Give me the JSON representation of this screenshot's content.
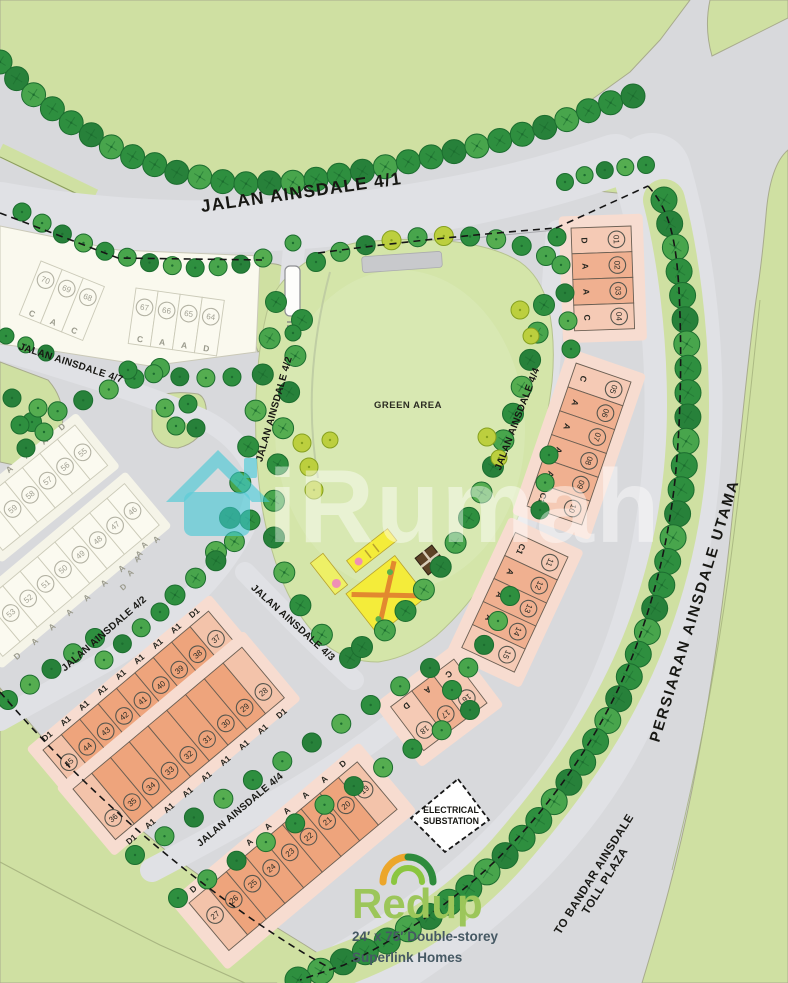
{
  "map": {
    "watermark": {
      "brand": "iRumah"
    },
    "green_area_label": "GREEN AREA",
    "road_labels": [
      {
        "id": "jalan-ainsdale-4-1",
        "text": "JALAN AINSDALE 4/1",
        "x": 302,
        "y": 198,
        "rot": -8,
        "size": 17.5,
        "ls": 1.2
      },
      {
        "id": "jalan-ainsdale-4-7",
        "text": "JALAN AINSDALE 4/7",
        "x": 70,
        "y": 366,
        "rot": 18,
        "size": 10,
        "ls": 0.3
      },
      {
        "id": "jalan-ainsdale-4-2-upper",
        "text": "JALAN AINSDALE 4/2",
        "x": 277,
        "y": 410,
        "rot": -74,
        "size": 10,
        "ls": 0.3
      },
      {
        "id": "jalan-ainsdale-4-2-lower",
        "text": "JALAN AINSDALE 4/2",
        "x": 106,
        "y": 636,
        "rot": -41,
        "size": 10,
        "ls": 0.3
      },
      {
        "id": "jalan-ainsdale-4-3",
        "text": "JALAN AINSDALE 4/3",
        "x": 291,
        "y": 625,
        "rot": 42,
        "size": 10,
        "ls": 0.3
      },
      {
        "id": "jalan-ainsdale-4-4-lower",
        "text": "JALAN AINSDALE 4/4",
        "x": 242,
        "y": 812,
        "rot": -40,
        "size": 10,
        "ls": 0.3
      },
      {
        "id": "jalan-ainsdale-4-4-upper",
        "text": "JALAN AINSDALE 4/4",
        "x": 520,
        "y": 420,
        "rot": -69,
        "size": 10,
        "ls": 0.3
      },
      {
        "id": "persiaran-ainsdale-utama",
        "text": "PERSIARAN AINSDALE UTAMA",
        "x": 699,
        "y": 612,
        "rot": -73,
        "size": 15,
        "ls": 2
      }
    ],
    "toll_label": {
      "lines": [
        "TO BANDAR AINSDALE",
        "TOLL PLAZA"
      ],
      "x": 597,
      "y": 876,
      "rot": -58,
      "size": 11.5
    },
    "substation": {
      "lines": [
        "ELECTRICAL",
        "SUBSTATION"
      ],
      "x": 451,
      "y": 813
    },
    "logo": {
      "name": "Redup",
      "tagline": [
        "24′ x 75′ Double-storey",
        "Superlink Homes"
      ]
    },
    "extra_letters": [
      {
        "t": "A",
        "x": 146,
        "y": 547
      },
      {
        "t": "A",
        "x": 139,
        "y": 561
      },
      {
        "t": "A",
        "x": 132,
        "y": 575
      },
      {
        "t": "D",
        "x": 125,
        "y": 589
      }
    ],
    "lot_rows": [
      {
        "id": "row-37-45",
        "origin": [
          43,
          750
        ],
        "rot": -40,
        "cw": 24,
        "n": 9,
        "depth": 66,
        "pad": 12,
        "numY": 26,
        "letterY": -8,
        "numbers": [
          "45",
          "44",
          "43",
          "42",
          "41",
          "40",
          "39",
          "38",
          "37"
        ],
        "letters": [
          "D1",
          "A1",
          "A1",
          "A1",
          "A1",
          "A1",
          "A1",
          "A1",
          "D1"
        ],
        "style": "pink"
      },
      {
        "id": "row-28-36",
        "origin": [
          73,
          789
        ],
        "rot": -40,
        "cw": 24.5,
        "n": 9,
        "depth": 66,
        "pad": 12,
        "numY": 48,
        "letterY": 76,
        "numbers": [
          "36",
          "35",
          "34",
          "33",
          "32",
          "31",
          "30",
          "29",
          "28"
        ],
        "letters": [
          "D1",
          "A1",
          "A1",
          "A1",
          "A1",
          "A1",
          "A1",
          "A1",
          "D1"
        ],
        "style": "pink"
      },
      {
        "id": "row-19-27",
        "origin": [
          189,
          903
        ],
        "rot": -40,
        "cw": 24.4,
        "n": 9,
        "depth": 62,
        "pad": 14,
        "numY": 26,
        "letterY": -8,
        "numbers": [
          "27",
          "26",
          "25",
          "24",
          "23",
          "22",
          "21",
          "20",
          "19"
        ],
        "letters": [
          "D",
          "A",
          "A",
          "A",
          "A",
          "A",
          "A",
          "A",
          "D"
        ],
        "style": "pink"
      },
      {
        "id": "block-01-04",
        "origin": [
          631,
          226
        ],
        "rot": 88,
        "cw": 25.7,
        "n": 4,
        "depth": 60,
        "pad": 12,
        "numY": 15,
        "letterY": 47,
        "numbers": [
          "01",
          "02",
          "03",
          "04"
        ],
        "letters": [
          "D",
          "A",
          "A",
          "C"
        ],
        "style": "pink2"
      },
      {
        "id": "block-05-10",
        "origin": [
          631,
          382
        ],
        "rot": 109,
        "cw": 25.2,
        "n": 6,
        "depth": 58,
        "pad": 12,
        "numY": 14,
        "letterY": 46,
        "numbers": [
          "05",
          "06",
          "07",
          "08",
          "09",
          "10"
        ],
        "letters": [
          "C",
          "A",
          "A",
          "A",
          "A",
          "C1"
        ],
        "style": "pink2"
      },
      {
        "id": "block-11-15",
        "origin": [
          568,
          557
        ],
        "rot": 115,
        "cw": 25.4,
        "n": 5,
        "depth": 58,
        "pad": 12,
        "numY": 14,
        "letterY": 46,
        "numbers": [
          "11",
          "12",
          "13",
          "14",
          "15"
        ],
        "letters": [
          "C1",
          "A",
          "A",
          "A",
          "C"
        ],
        "style": "pink2"
      },
      {
        "id": "block-16-18",
        "origin": [
          487,
          703
        ],
        "rot": 143,
        "cw": 26.4,
        "n": 3,
        "depth": 55,
        "pad": 12,
        "numY": 16,
        "letterY": 46,
        "numbers": [
          "16",
          "17",
          "18"
        ],
        "letters": [
          "C",
          "A",
          "D"
        ],
        "style": "pink2"
      },
      {
        "id": "row-55-59",
        "origin": [
          -30,
          510
        ],
        "rot": -39,
        "cw": 22.5,
        "n": 6,
        "depth": 52,
        "pad": 9,
        "numY": 26,
        "letterY": -7,
        "numbers": [
          "",
          "59",
          "58",
          "57",
          "56",
          "55"
        ],
        "letters": [
          "",
          "A",
          "A",
          "A",
          "A",
          "D"
        ],
        "style": "white"
      },
      {
        "id": "row-46-53",
        "origin": [
          -32,
          615
        ],
        "rot": -40,
        "cw": 22.7,
        "n": 9,
        "depth": 54,
        "pad": 9,
        "numY": 26,
        "letterY": 63,
        "numbers": [
          "",
          "53",
          "52",
          "51",
          "50",
          "49",
          "48",
          "47",
          "46"
        ],
        "letters": [
          "D",
          "A",
          "A",
          "A",
          "A",
          "A",
          "A",
          "A",
          "A"
        ],
        "style": "white"
      },
      {
        "id": "block-68-70",
        "origin": [
          41,
          261
        ],
        "rot": 22,
        "cw": 22.8,
        "n": 3,
        "depth": 58,
        "pad": 0,
        "numY": 16,
        "letterY": 52,
        "numbers": [
          "70",
          "69",
          "68"
        ],
        "letters": [
          "C",
          "A",
          "C"
        ],
        "style": "white"
      },
      {
        "id": "block-64-67",
        "origin": [
          136,
          288
        ],
        "rot": 8,
        "cw": 22.3,
        "n": 4,
        "depth": 56,
        "pad": 0,
        "numY": 18,
        "letterY": 50,
        "numbers": [
          "67",
          "66",
          "65",
          "64"
        ],
        "letters": [
          "C",
          "A",
          "A",
          "D"
        ],
        "style": "white"
      }
    ],
    "colors": {
      "road": "#d8d9dc",
      "road_light": "#e0e1e5",
      "green": "#cfe0a2",
      "park": "#d4e5a9",
      "tree_dark": "#2e8f3f",
      "tree_mid": "#48a54c",
      "tree_deep": "#27813a",
      "tree_lime": "#bccf3e",
      "pink_cell": "#eea47c",
      "pink_end": "#f3c3aa",
      "pink2_cell": "#f0b090",
      "pink2_end": "#f5cab5",
      "pink_verge": "#f7dcd0",
      "white_cell": "#fbfaf0",
      "white_verge": "#f5f4e8",
      "label": "#171713",
      "wm_teal": "#3ec8d6",
      "redup_green": "#9cc65a",
      "tagline": "#465964",
      "logo_gold": "#eca62b",
      "logo_dgreen": "#2e8b3c",
      "logo_lgreen": "#8bc63f",
      "playground_yellow": "#f4ec3a"
    }
  }
}
